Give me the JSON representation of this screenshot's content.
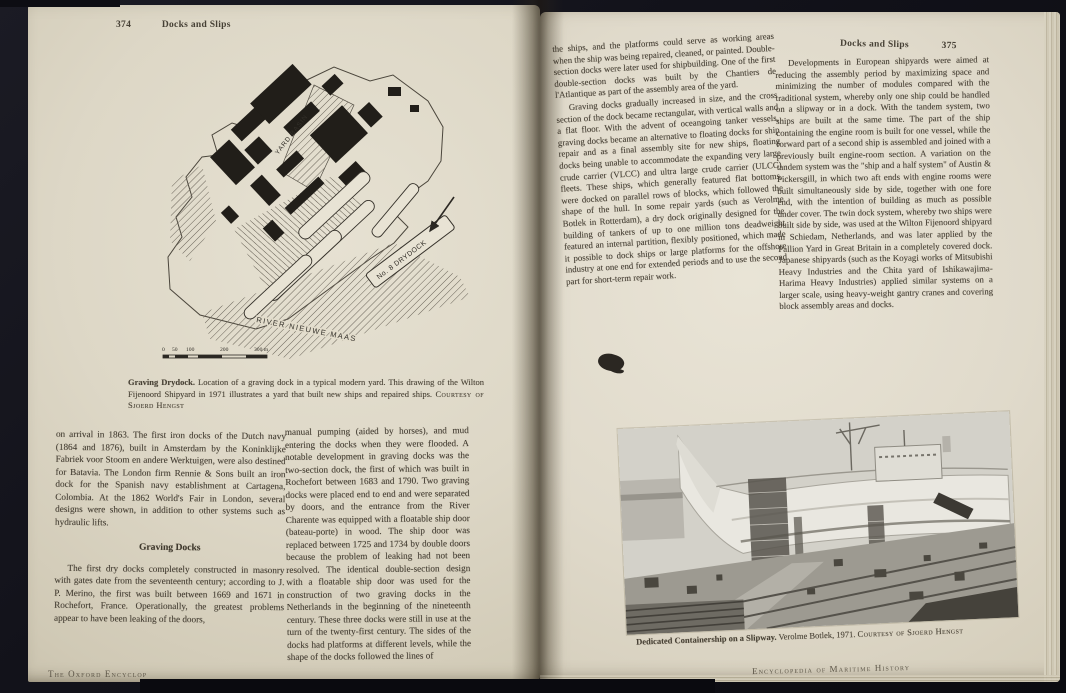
{
  "book": {
    "footer_left": "The Oxford Encyclop",
    "footer_right": "Encyclopedia of Maritime History"
  },
  "left_page": {
    "page_number": "374",
    "running_head": "Docks and Slips",
    "figure": {
      "labels": {
        "yard_basin": "YARD BASIN",
        "drydock": "No. 8 DRYDOCK",
        "river": "RIVER NIEUWE MAAS"
      },
      "scale_ticks": [
        "0",
        "50",
        "100",
        "200",
        "300 m"
      ]
    },
    "figure_caption": {
      "lead": "Graving Drydock.",
      "text": " Location of a graving dock in a typical modern yard. This drawing of the Wilton Fijenoord Shipyard in 1971 illustrates a yard that built new ships and repaired ships. ",
      "courtesy": "Courtesy of Sjoerd Hengst"
    },
    "column1": {
      "para1": "on arrival in 1863. The first iron docks of the Dutch navy (1864 and 1876), built in Amsterdam by the Koninklijke Fabriek voor Stoom en andere Werktuigen, were also destined for Batavia. The London firm Rennie & Sons built an iron dock for the Spanish navy establishment at Cartagena, Colombia. At the 1862 World's Fair in London, several designs were shown, in addition to other systems such as hydraulic lifts.",
      "heading": "Graving Docks",
      "para2": "The first dry docks completely constructed in masonry with gates date from the seventeenth century; according to J. P. Merino, the first was built between 1669 and 1671 in Rochefort, France. Operationally, the greatest problems appear to have been leaking of the doors,"
    },
    "column2": {
      "para1": "manual pumping (aided by horses), and mud entering the docks when they were flooded. A notable development in graving docks was the two-section dock, the first of which was built in Rochefort between 1683 and 1790. Two graving docks were placed end to end and were separated by doors, and the entrance from the River Charente was equipped with a floatable ship door (bateau-porte) in wood. The ship door was replaced between 1725 and 1734 by double doors because the problem of leaking had not been resolved. The identical double-section design with a floatable ship door was used for the construction of two graving docks in the Netherlands in the beginning of the nineteenth century. These three docks were still in use at the turn of the twenty-first century. The sides of the docks had platforms at different levels, while the shape of the docks followed the lines of"
    }
  },
  "right_page": {
    "page_number": "375",
    "running_head": "Docks and Slips",
    "column1": {
      "para1": "the ships, and the platforms could serve as working areas when the ship was being repaired, cleaned, or painted. Double-section docks were later used for shipbuilding. One of the first double-section docks was built by the Chantiers de l'Atlantique as part of the assembly area of the yard.",
      "para2": "Graving docks gradually increased in size, and the cross section of the dock became rectangular, with vertical walls and a flat floor. With the advent of oceangoing tanker vessels, graving docks became an alternative to floating docks for ship repair and as a final assembly site for new ships, floating docks being unable to accommodate the expanding very large crude carrier (VLCC) and ultra large crude carrier (ULCC) fleets. These ships, which generally featured flat bottoms, were docked on parallel rows of blocks, which followed the shape of the hull. In some repair yards (such as Verolme Botlek in Rotterdam), a dry dock originally designed for the building of tankers of up to one million tons deadweight featured an internal partition, flexibly positioned, which made it possible to dock ships or large platforms for the offshore industry at one end for extended periods and to use the second part for short-term repair work."
    },
    "column2": {
      "para1": "Developments in European shipyards were aimed at reducing the assembly period by maximizing space and minimizing the number of modules compared with the traditional system, whereby only one ship could be handled on a slipway or in a dock. With the tandem system, two ships are built at the same time. The part of the ship containing the engine room is built for one vessel, while the forward part of a second ship is assembled and joined with a previously built engine-room section. A variation on the tandem system was the \"ship and a half system\" of Austin & Pickersgill, in which two aft ends with engine rooms were built simultaneously side by side, together with one fore end, with the intention of building as much as possible under cover. The twin dock system, whereby two ships were built side by side, was used at the Wilton Fijenoord shipyard in Schiedam, Netherlands, and was later applied by the Pallion Yard in Great Britain in a completely covered dock. Japanese shipyards (such as the Koyagi works of Mitsubishi Heavy Industries and the Chita yard of Ishikawajima-Harima Heavy Industries) applied similar systems on a larger scale, using heavy-weight gantry cranes and covering block assembly areas and docks."
    },
    "photo_caption": {
      "lead": "Dedicated Containership on a Slipway.",
      "text": " Verolme Botlek, 1971. ",
      "courtesy": "Courtesy of Sjoerd Hengst"
    }
  },
  "colors": {
    "page_cream": "#e0dacb",
    "cover_dark": "#101016",
    "ink": "#433d33"
  }
}
